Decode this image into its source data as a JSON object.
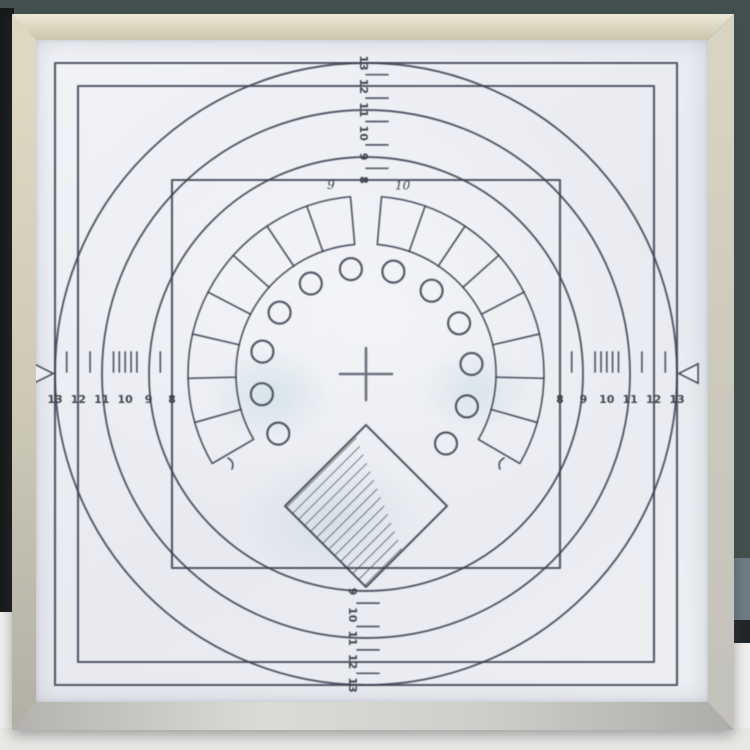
{
  "background": {
    "wall_top": "#42514f",
    "left_edge": "#17191b",
    "wall_right_upper": "#42514f",
    "wall_right_lower": "#6d7c83",
    "dark_band_right": "#202527",
    "right_wall_white": "#f1f0ee",
    "table": "#e9e8e5"
  },
  "frame": {
    "top_tint": "#ece8d6",
    "left_tint": "#ddd8c2",
    "right_tint": "#d6d2c0",
    "bottom_tint": "#c9c7c2",
    "paper": "#edeff4"
  },
  "chart": {
    "ink": "#3a4050",
    "cx": 366,
    "cy": 374,
    "unit_px": 23.4,
    "rects": [
      {
        "label": "13",
        "half": 311
      },
      {
        "label": "12",
        "half": 288
      },
      {
        "label": "8",
        "half": 194
      }
    ],
    "circles": [
      {
        "label": "13",
        "r": 311
      },
      {
        "label": "11",
        "r": 264
      },
      {
        "label": "9",
        "r": 217
      }
    ],
    "wedge": {
      "r_in": 130,
      "r_out": 178,
      "step": 14.4,
      "sides": [
        {
          "start": 95,
          "count": 8
        },
        {
          "start": -30.2,
          "count": 8
        }
      ],
      "label_r": 192,
      "labels": [
        {
          "text": "9",
          "angle": 100.5
        },
        {
          "text": "10",
          "angle": 79
        }
      ]
    },
    "dots": {
      "r": 106,
      "dot_r": 11,
      "count": 12,
      "start": -41,
      "step": 23.2
    },
    "diamond": {
      "cx": 366,
      "cy": 506,
      "half": 81,
      "hatch_t1": 0.13,
      "hatch_t2": 0.45,
      "hatch_spacing": 8.5
    },
    "crosshair": {
      "arm": 26
    },
    "end_marks": [
      {
        "d": "M 228 458 q 7 4 4 11"
      },
      {
        "d": "M 504 458 q -7 4 -4 11"
      }
    ],
    "scales": {
      "top": {
        "labels": [
          "13",
          "12",
          "11",
          "10",
          "9",
          "8"
        ],
        "base": 63,
        "first": 13,
        "step": 23.4,
        "ticks": [
          12.5,
          11.5,
          10.5,
          9.5,
          8.5
        ],
        "label_x": 360,
        "tick_x": [
          366,
          388
        ]
      },
      "bottom": {
        "labels": [
          "9",
          "10",
          "11",
          "12",
          "13"
        ],
        "base": 591.4,
        "first": 9,
        "step": 23.4,
        "ticks": [
          9.5,
          10.5,
          11.5,
          12.5
        ],
        "label_x": 349,
        "tick_x": [
          357,
          379
        ]
      },
      "left": {
        "labels": [
          "13",
          "12",
          "11",
          "10",
          "9",
          "8"
        ],
        "base": 55,
        "first": 13,
        "step": 23.4,
        "ticks": [
          12.5,
          11.5,
          10.5,
          10.25,
          10,
          9.75,
          9.5,
          8.5
        ],
        "label_y": 403,
        "tick_y": [
          352,
          372
        ],
        "triangle": "34,364 34,383 53,373.5"
      },
      "right": {
        "labels": [
          "8",
          "9",
          "10",
          "11",
          "12",
          "13"
        ],
        "base": 560,
        "first": 8,
        "step": 23.4,
        "ticks": [
          8.5,
          9.5,
          9.75,
          10,
          10.25,
          10.5,
          11.5,
          12.5
        ],
        "label_y": 403,
        "tick_y": [
          352,
          372
        ],
        "triangle": "698,364 698,383 679,373.5"
      }
    }
  }
}
